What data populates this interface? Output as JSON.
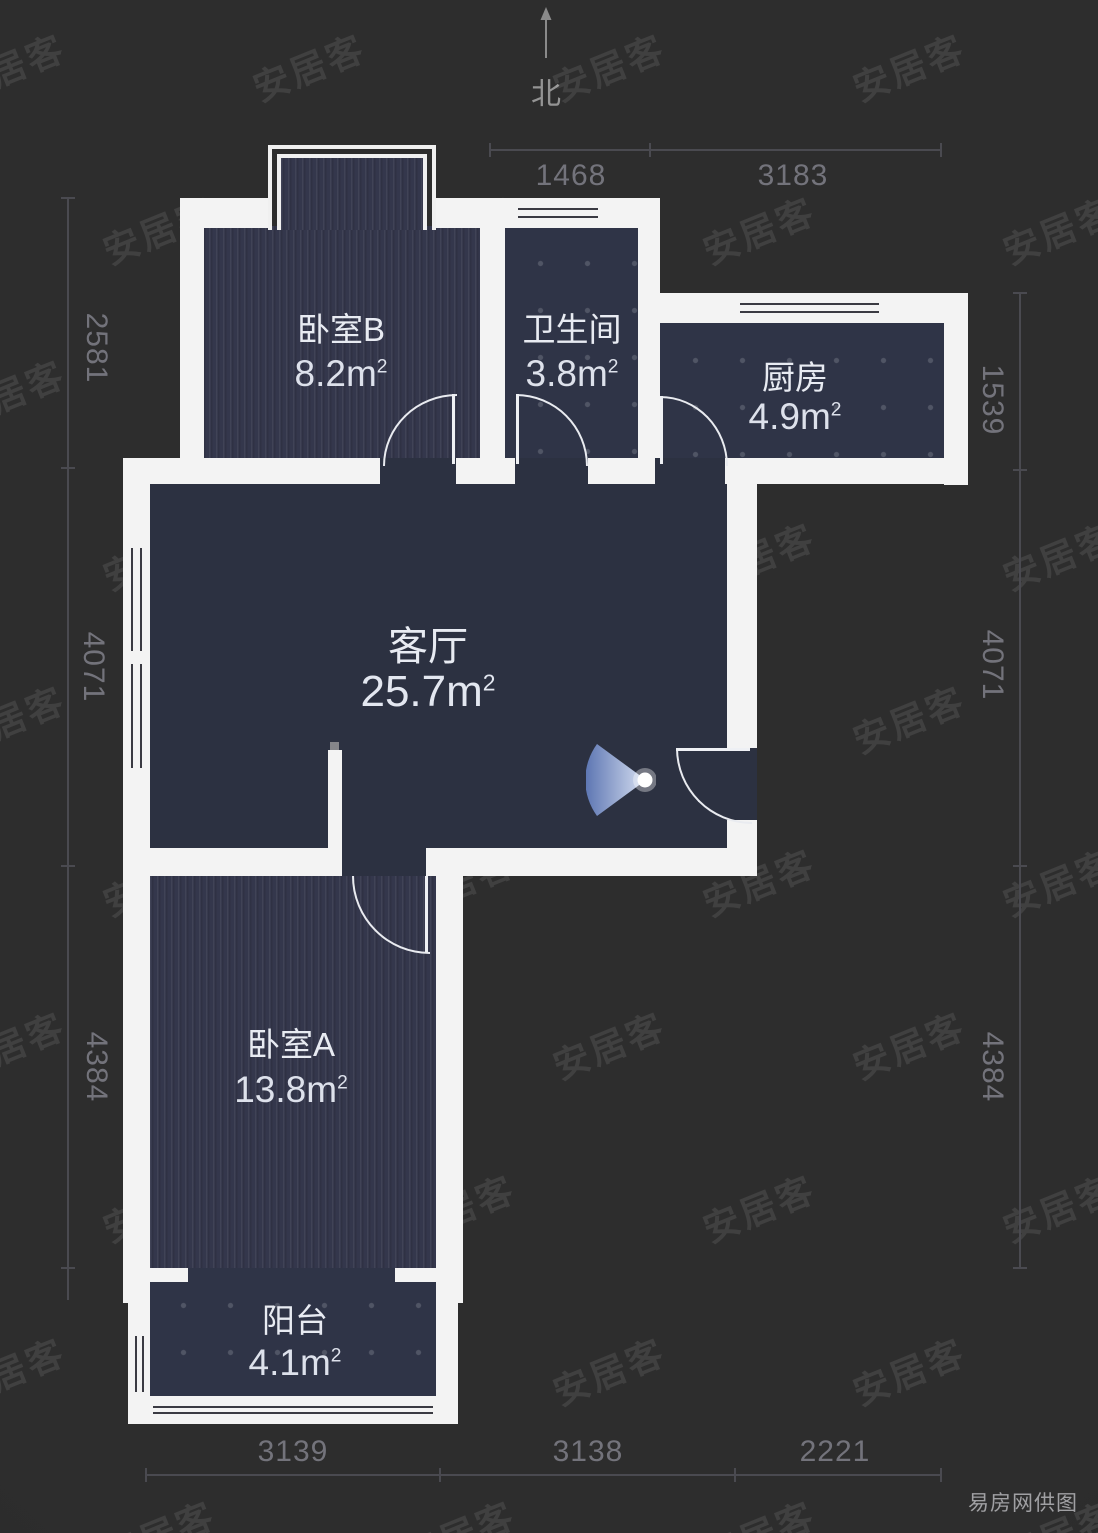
{
  "meta": {
    "north_label": "北",
    "watermark": "安居客",
    "credit": "易房网供图",
    "area_unit": "m",
    "area_unit_sup": "2"
  },
  "colors": {
    "background": "#2b2b2b",
    "wall": "#f3f3f3",
    "room_striped": "#34374c",
    "room_tiled": "#2f3447",
    "room_flat": "#2c3141",
    "dimension_text": "#73737b",
    "label_text": "#e8ebf2",
    "light_cone_start": "#5f79b8",
    "light_cone_end": "#dfe8fa"
  },
  "floorplan": {
    "width": 1098,
    "height": 1533,
    "rooms": [
      {
        "id": "bedroom-b",
        "name": "卧室B",
        "area": "8.2",
        "x": 202,
        "y": 226,
        "w": 278,
        "h": 234,
        "texture": "stripes",
        "lx": 341,
        "ly": 327,
        "ay": 374,
        "size": "s"
      },
      {
        "id": "bathroom",
        "name": "卫生间",
        "area": "3.8",
        "x": 505,
        "y": 226,
        "w": 133,
        "h": 234,
        "texture": "tiles",
        "lx": 572,
        "ly": 327,
        "ay": 374,
        "size": "s"
      },
      {
        "id": "kitchen",
        "name": "厨房",
        "area": "4.9",
        "x": 660,
        "y": 323,
        "w": 284,
        "h": 135,
        "texture": "tiles",
        "lx": 795,
        "ly": 375,
        "ay": 417,
        "size": "s"
      },
      {
        "id": "living-room",
        "name": "客厅",
        "area": "25.7",
        "x": 150,
        "y": 484,
        "w": 577,
        "h": 364,
        "texture": "flat",
        "lx": 428,
        "ly": 643,
        "ay": 692,
        "size": "l"
      },
      {
        "id": "bedroom-a",
        "name": "卧室A",
        "area": "13.8",
        "x": 150,
        "y": 876,
        "w": 286,
        "h": 392,
        "texture": "stripes",
        "lx": 291,
        "ly": 1042,
        "ay": 1090,
        "size": "s"
      },
      {
        "id": "balcony",
        "name": "阳台",
        "area": "4.1",
        "x": 148,
        "y": 1268,
        "w": 290,
        "h": 128,
        "texture": "tiles",
        "lx": 295,
        "ly": 1318,
        "ay": 1363,
        "size": "s"
      }
    ],
    "walls": [
      {
        "x": 180,
        "y": 198,
        "w": 24,
        "h": 282
      },
      {
        "x": 180,
        "y": 198,
        "w": 90,
        "h": 30
      },
      {
        "x": 434,
        "y": 198,
        "w": 226,
        "h": 30
      },
      {
        "x": 480,
        "y": 228,
        "w": 25,
        "h": 230
      },
      {
        "x": 638,
        "y": 198,
        "w": 22,
        "h": 285
      },
      {
        "x": 638,
        "y": 293,
        "w": 330,
        "h": 30
      },
      {
        "x": 944,
        "y": 293,
        "w": 24,
        "h": 192
      },
      {
        "x": 123,
        "y": 458,
        "w": 257,
        "h": 26
      },
      {
        "x": 456,
        "y": 458,
        "w": 59,
        "h": 26
      },
      {
        "x": 588,
        "y": 458,
        "w": 67,
        "h": 26
      },
      {
        "x": 725,
        "y": 458,
        "w": 243,
        "h": 26
      },
      {
        "x": 123,
        "y": 458,
        "w": 27,
        "h": 412
      },
      {
        "x": 727,
        "y": 484,
        "w": 30,
        "h": 264
      },
      {
        "x": 727,
        "y": 820,
        "w": 30,
        "h": 56
      },
      {
        "x": 123,
        "y": 848,
        "w": 219,
        "h": 28
      },
      {
        "x": 426,
        "y": 848,
        "w": 331,
        "h": 28
      },
      {
        "x": 123,
        "y": 876,
        "w": 27,
        "h": 427
      },
      {
        "x": 436,
        "y": 876,
        "w": 27,
        "h": 427
      },
      {
        "x": 140,
        "y": 1268,
        "w": 48,
        "h": 14
      },
      {
        "x": 395,
        "y": 1268,
        "w": 43,
        "h": 14
      },
      {
        "x": 128,
        "y": 1282,
        "w": 22,
        "h": 142
      },
      {
        "x": 436,
        "y": 1282,
        "w": 22,
        "h": 142
      },
      {
        "x": 128,
        "y": 1396,
        "w": 330,
        "h": 28
      }
    ],
    "connectors": [
      {
        "x": 380,
        "y": 458,
        "w": 76,
        "h": 26,
        "fill": "flat"
      },
      {
        "x": 515,
        "y": 458,
        "w": 73,
        "h": 26,
        "fill": "flat"
      },
      {
        "x": 655,
        "y": 458,
        "w": 70,
        "h": 26,
        "fill": "flat"
      },
      {
        "x": 342,
        "y": 848,
        "w": 84,
        "h": 28,
        "fill": "flat"
      },
      {
        "x": 727,
        "y": 748,
        "w": 30,
        "h": 72,
        "fill": "flat"
      },
      {
        "x": 188,
        "y": 1268,
        "w": 207,
        "h": 14,
        "fill": "tiles"
      }
    ],
    "windows": [
      {
        "dir": "h",
        "x": 515,
        "y": 200,
        "w": 86,
        "h": 26,
        "transom": false
      },
      {
        "dir": "h",
        "x": 737,
        "y": 295,
        "w": 145,
        "h": 26,
        "transom": false
      },
      {
        "dir": "v",
        "x": 123,
        "y": 545,
        "w": 27,
        "h": 226,
        "transom": true
      },
      {
        "dir": "v",
        "x": 128,
        "y": 1333,
        "w": 22,
        "h": 62,
        "transom": false
      },
      {
        "dir": "h",
        "x": 150,
        "y": 1400,
        "w": 286,
        "h": 20,
        "transom": false
      }
    ],
    "doors": [
      {
        "x": 383,
        "y": 394,
        "w": 72,
        "h": 70,
        "hinge": "br",
        "leaf": "right"
      },
      {
        "x": 516,
        "y": 394,
        "w": 70,
        "h": 70,
        "hinge": "bl",
        "leaf": "left"
      },
      {
        "x": 660,
        "y": 396,
        "w": 66,
        "h": 68,
        "hinge": "bl",
        "leaf": "left"
      },
      {
        "x": 676,
        "y": 748,
        "w": 74,
        "h": 74,
        "hinge": "tr",
        "leaf": "top"
      },
      {
        "x": 352,
        "y": 876,
        "w": 76,
        "h": 76,
        "hinge": "tr",
        "leaf": "right"
      }
    ],
    "bay_window": {
      "x": 268,
      "y": 145,
      "w": 168,
      "h": 85
    },
    "stub": {
      "x": 328,
      "y": 750,
      "w": 14,
      "h": 102
    },
    "light": {
      "x": 586,
      "y": 733,
      "w": 70,
      "h": 94
    },
    "dimensions": {
      "top": {
        "line": {
          "x": 490,
          "y": 150,
          "len": 451
        },
        "ticks": [
          490,
          650,
          941
        ],
        "labels": [
          {
            "t": "1468",
            "cx": 571,
            "cy": 176
          },
          {
            "t": "3183",
            "cx": 793,
            "cy": 176
          }
        ]
      },
      "bottom": {
        "line": {
          "x": 146,
          "y": 1475,
          "len": 795
        },
        "ticks": [
          146,
          440,
          735,
          941
        ],
        "labels": [
          {
            "t": "3139",
            "cx": 293,
            "cy": 1452
          },
          {
            "t": "3138",
            "cx": 588,
            "cy": 1452
          },
          {
            "t": "2221",
            "cx": 835,
            "cy": 1452
          }
        ]
      },
      "left": {
        "line": {
          "x": 68,
          "y": 198,
          "len": 1102
        },
        "ticks": [
          198,
          468,
          866,
          1268
        ],
        "labels": [
          {
            "t": "2581",
            "cx": 96,
            "cy": 348
          },
          {
            "t": "4071",
            "cx": 93,
            "cy": 667
          },
          {
            "t": "4384",
            "cx": 96,
            "cy": 1067
          }
        ]
      },
      "right": {
        "line": {
          "x": 1020,
          "y": 293,
          "len": 975
        },
        "ticks": [
          293,
          470,
          866,
          1268
        ],
        "labels": [
          {
            "t": "1539",
            "cx": 992,
            "cy": 400
          },
          {
            "t": "4071",
            "cx": 992,
            "cy": 665
          },
          {
            "t": "4384",
            "cx": 992,
            "cy": 1067
          }
        ]
      }
    },
    "watermark_grid": {
      "rows": 10,
      "cols": 4,
      "x0": -50,
      "y0": 40,
      "dx": 300,
      "dy": 163,
      "row_offset": 150
    }
  }
}
